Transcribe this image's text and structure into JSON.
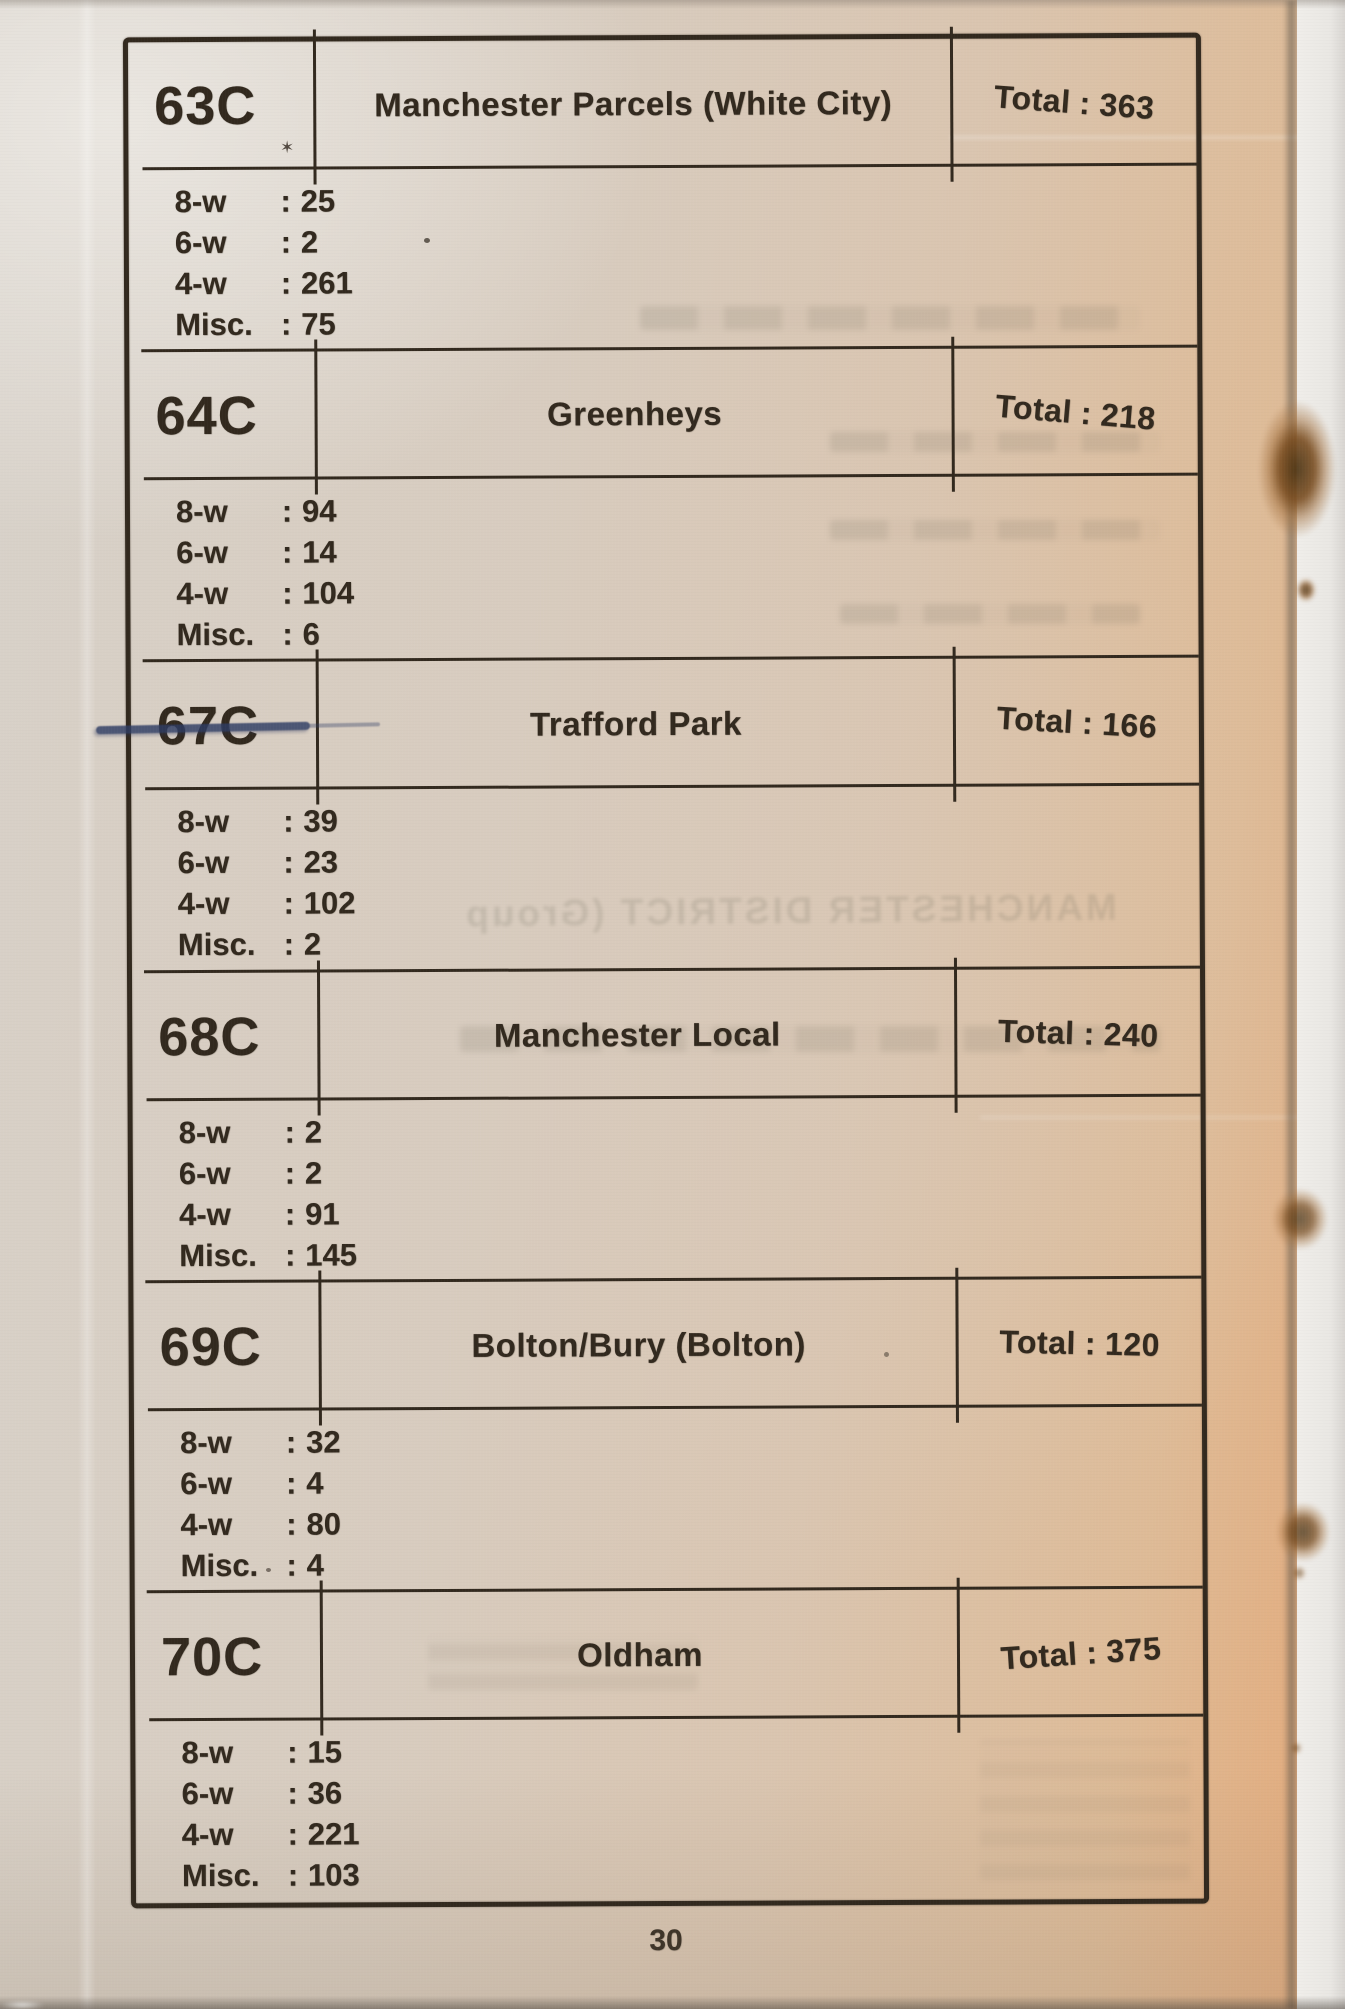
{
  "document": {
    "page_number": "30",
    "bleedthrough_text": "MANCHESTER DISTRICT (Group",
    "colon": ":"
  },
  "sections": [
    {
      "code": "63C",
      "name": "Manchester Parcels (White City)",
      "total_label": "Total",
      "total_value": "363",
      "stats": [
        {
          "label": "8-w",
          "value": "25"
        },
        {
          "label": "6-w",
          "value": "2"
        },
        {
          "label": "4-w",
          "value": "261"
        },
        {
          "label": "Misc.",
          "value": "75"
        }
      ]
    },
    {
      "code": "64C",
      "name": "Greenheys",
      "total_label": "Total",
      "total_value": "218",
      "stats": [
        {
          "label": "8-w",
          "value": "94"
        },
        {
          "label": "6-w",
          "value": "14"
        },
        {
          "label": "4-w",
          "value": "104"
        },
        {
          "label": "Misc.",
          "value": "6"
        }
      ]
    },
    {
      "code": "67C",
      "name": "Trafford Park",
      "total_label": "Total",
      "total_value": "166",
      "stats": [
        {
          "label": "8-w",
          "value": "39"
        },
        {
          "label": "6-w",
          "value": "23"
        },
        {
          "label": "4-w",
          "value": "102"
        },
        {
          "label": "Misc.",
          "value": "2"
        }
      ]
    },
    {
      "code": "68C",
      "name": "Manchester Local",
      "total_label": "Total",
      "total_value": "240",
      "stats": [
        {
          "label": "8-w",
          "value": "2"
        },
        {
          "label": "6-w",
          "value": "2"
        },
        {
          "label": "4-w",
          "value": "91"
        },
        {
          "label": "Misc.",
          "value": "145"
        }
      ]
    },
    {
      "code": "69C",
      "name": "Bolton/Bury (Bolton)",
      "total_label": "Total",
      "total_value": "120",
      "stats": [
        {
          "label": "8-w",
          "value": "32"
        },
        {
          "label": "6-w",
          "value": "4"
        },
        {
          "label": "4-w",
          "value": "80"
        },
        {
          "label": "Misc.",
          "value": "4"
        }
      ]
    },
    {
      "code": "70C",
      "name": "Oldham",
      "total_label": "Total",
      "total_value": "375",
      "stats": [
        {
          "label": "8-w",
          "value": "15"
        },
        {
          "label": "6-w",
          "value": "36"
        },
        {
          "label": "4-w",
          "value": "221"
        },
        {
          "label": "Misc.",
          "value": "103"
        }
      ]
    }
  ],
  "colors": {
    "ink": "#32291e",
    "annotation_ink": "#2e3c63",
    "paper": "#d8cbbc",
    "foxing": "#7a4d20"
  }
}
